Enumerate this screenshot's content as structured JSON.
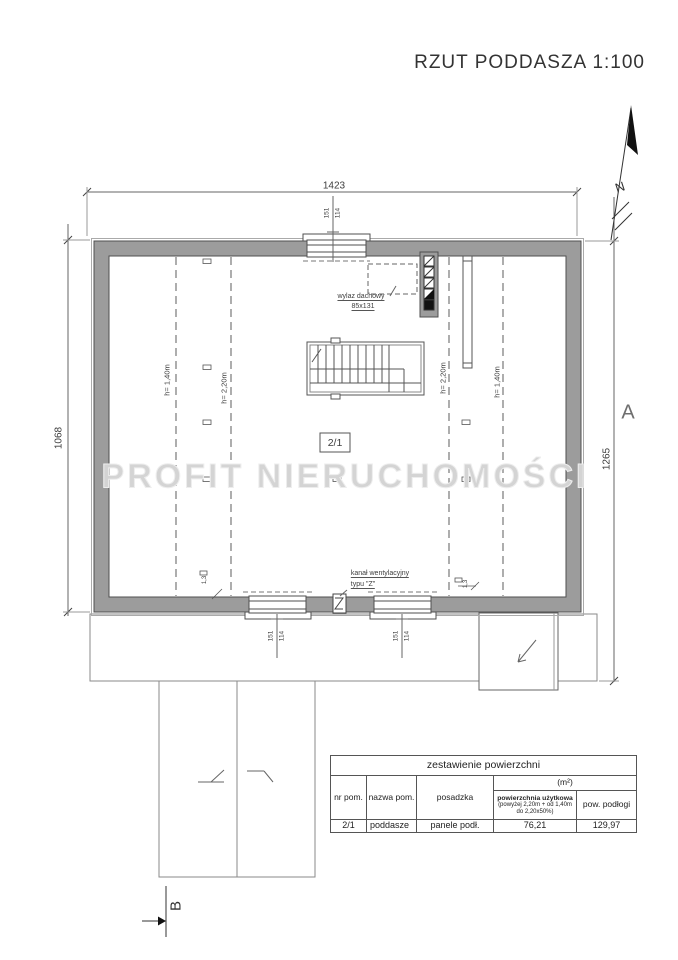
{
  "title": "RZUT PODDASZA 1:100",
  "compass": {
    "north_label": "N"
  },
  "watermark": "PROFIT NIERUCHOMOŚCI",
  "dimensions": {
    "width_top": "1423",
    "height_left": "1068",
    "height_right": "1265",
    "window_width": "151",
    "window_height": "114",
    "knee_wall_small": "1,3"
  },
  "annotations": {
    "roof_hatch_label": "wylaz dachowy",
    "roof_hatch_size": "85x131",
    "vent_duct_label": "kanał wentylacyjny",
    "vent_duct_type": "typu \"Z\"",
    "height_line_140": "h= 1,40m",
    "height_line_220": "h= 2,20m",
    "room_number": "2/1",
    "section_marker_a": "A",
    "section_marker_b": "B"
  },
  "area_table": {
    "title": "zestawienie powierzchni",
    "unit_header": "(m²)",
    "columns": {
      "room_no": "nr pom.",
      "room_name": "nazwa pom.",
      "floor_finish": "posadzka",
      "usable_area": "powierzchnia użytkowa",
      "usable_area_note": "(powyżej 2,20m + od 1,40m do 2,20x50%)",
      "floor_area": "pow. podłogi"
    },
    "row": {
      "room_no": "2/1",
      "room_name": "poddasze",
      "floor_finish": "panele podł.",
      "usable_area": "76,21",
      "floor_area": "129,97"
    }
  }
}
